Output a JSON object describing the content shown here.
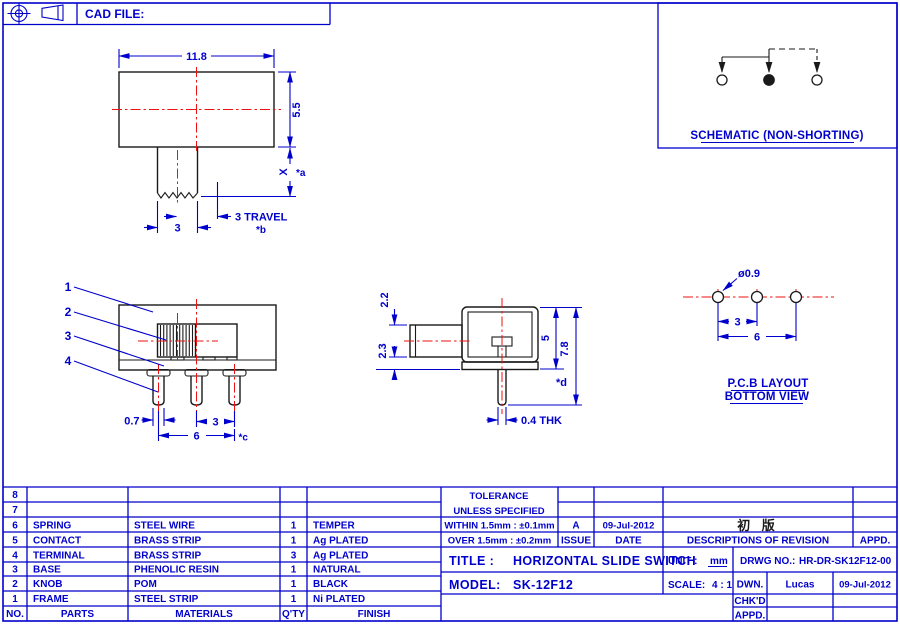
{
  "header": {
    "cad_file_label": "CAD FILE:"
  },
  "schematic": {
    "caption": "SCHEMATIC (NON-SHORTING)"
  },
  "pcb": {
    "hole_dia": "ø0.9",
    "pitch": "3",
    "span": "6",
    "caption1": "P.C.B LAYOUT",
    "caption2": "BOTTOM VIEW"
  },
  "top_view": {
    "width": "11.8",
    "height": "5.5",
    "x_dim": "X",
    "x_note": "*a",
    "knob_width": "3",
    "travel": "3 TRAVEL",
    "travel_note": "*b"
  },
  "front_view": {
    "callout1": "1",
    "callout2": "2",
    "callout3": "3",
    "callout4": "4",
    "pin_width": "0.7",
    "pitch": "3",
    "span": "6",
    "span_note": "*c"
  },
  "side_view": {
    "top_offset": "2.2",
    "bottom_offset": "2.3",
    "body_height": "5",
    "total_height": "7.8",
    "note": "*d",
    "pin_thickness": "0.4 THK"
  },
  "parts_table": {
    "headers": [
      "NO.",
      "PARTS",
      "MATERIALS",
      "Q'TY",
      "FINISH"
    ],
    "rows": [
      [
        "8",
        "",
        "",
        "",
        ""
      ],
      [
        "7",
        "",
        "",
        "",
        ""
      ],
      [
        "6",
        "SPRING",
        "STEEL WIRE",
        "1",
        "TEMPER"
      ],
      [
        "5",
        "CONTACT",
        "BRASS STRIP",
        "1",
        "Ag PLATED"
      ],
      [
        "4",
        "TERMINAL",
        "BRASS STRIP",
        "3",
        "Ag PLATED"
      ],
      [
        "3",
        "BASE",
        "PHENOLIC RESIN",
        "1",
        "NATURAL"
      ],
      [
        "2",
        "KNOB",
        "POM",
        "1",
        "BLACK"
      ],
      [
        "1",
        "FRAME",
        "STEEL STRIP",
        "1",
        "Ni PLATED"
      ]
    ]
  },
  "title_block": {
    "tolerance1": "TOLERANCE",
    "tolerance2": "UNLESS  SPECIFIED",
    "within": "WITHIN  1.5mm : ±0.1mm",
    "over": "OVER  1.5mm : ±0.2mm",
    "issue_value": "A",
    "issue_label": "ISSUE",
    "date_value": "09-Jul-2012",
    "date_label": "DATE",
    "revision_value": "初 版",
    "revision_label": "DESCRIPTIONS  OF  REVISION",
    "appd_label": "APPD.",
    "title_label": "TITLE :",
    "title_value": "HORIZONTAL  SLIDE  SWITCH",
    "model_label": "MODEL:",
    "model_value": "SK-12F12",
    "unit_label": "UNIT :",
    "unit_value": "mm",
    "drwg_label": "DRWG  NO.:",
    "drwg_value": "HR-DR-SK12F12-00",
    "scale_label": "SCALE:",
    "scale_value": "4 : 1",
    "dwn_label": "DWN.",
    "dwn_value": "Lucas",
    "dwn_date": "09-Jul-2012",
    "chkd_label": "CHK'D",
    "appd_row_label": "APPD."
  }
}
